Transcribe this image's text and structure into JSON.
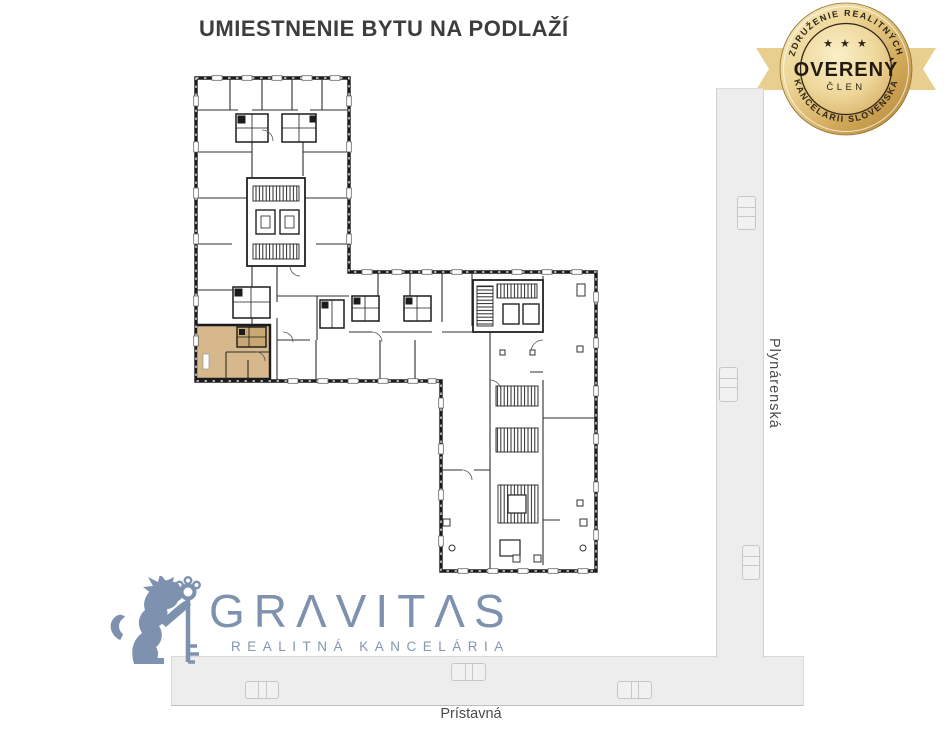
{
  "header": {
    "title": "UMIESTNENIE BYTU NA PODLAŽÍ"
  },
  "badge": {
    "arc_top": "ZDRUŽENIE REALITNÝCH",
    "arc_bottom": "KANCELÁRIÍ SLOVENSKA",
    "stars": "★ ★ ★",
    "label": "OVERENÝ",
    "sublabel": "ČLEN",
    "colors": {
      "gold_light": "#f8edc4",
      "gold_dark": "#b3873b",
      "ribbon": "#e9cf8f",
      "text": "#2e2518"
    }
  },
  "floor_plan": {
    "highlight_color": "#d6b88c",
    "wall_color": "#1b1b1b"
  },
  "streets": {
    "vertical_label": "Plynárenská",
    "horizontal_label": "Prístavná",
    "road_color": "#ededed"
  },
  "logo": {
    "brand": "GRAVITAS",
    "subtitle": "REALITNÁ KANCELÁRIA",
    "color": "#7e92b0"
  }
}
